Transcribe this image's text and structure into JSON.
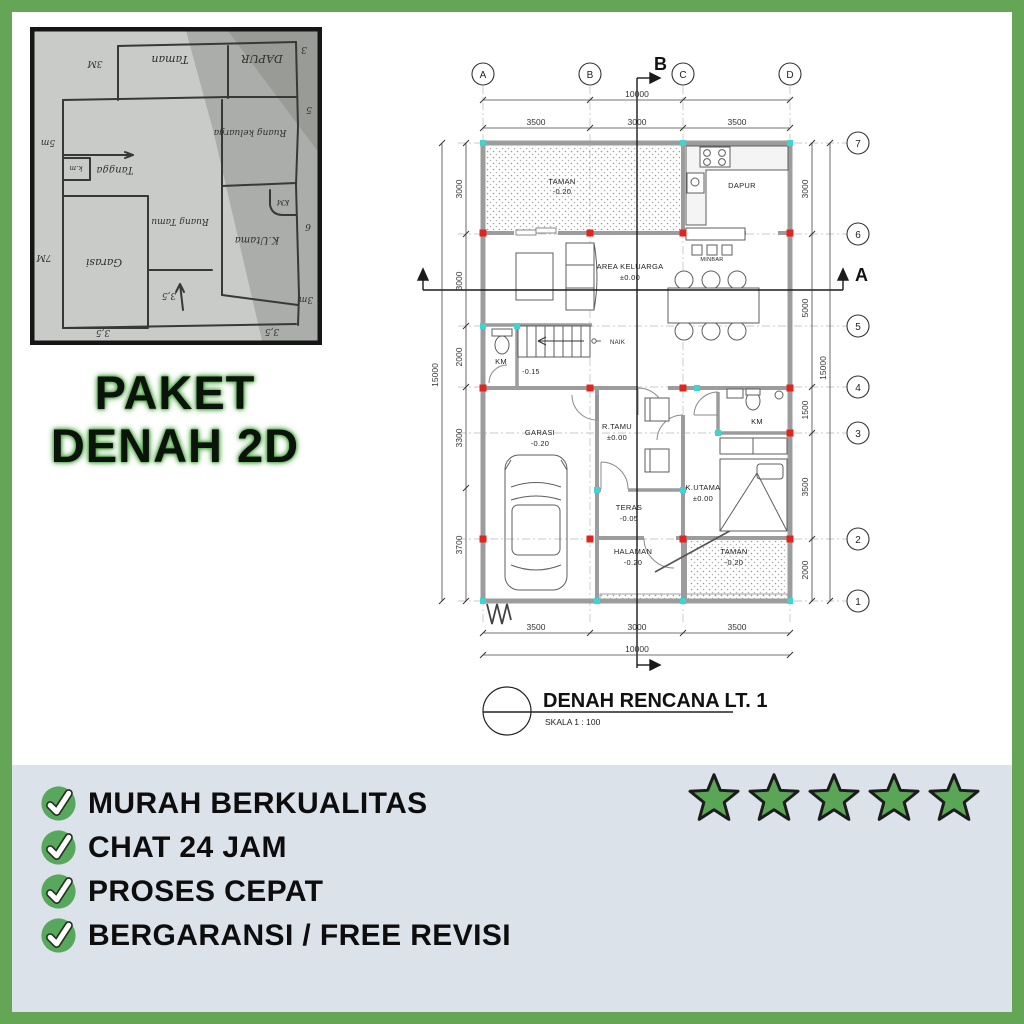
{
  "header": {
    "package_title_line1": "PAKET",
    "package_title_line2": "DENAH 2D"
  },
  "sketch": {
    "labels": {
      "taman": "Taman",
      "dapur": "DAPUR",
      "ruang_keluarga": "Ruang keluarga",
      "tangga": "Tangga",
      "km_tangga": "k.m",
      "garasi": "Garasi",
      "ruang_tamu": "Ruang Tamu",
      "k_utama": "K.Utama",
      "km_kamar": "KM",
      "dim_3m_kiri": "3M",
      "dim_3_kanan": "3",
      "dim_5_kanan": "5",
      "dim_5m_kiri": "5m",
      "dim_6_kanan": "6",
      "dim_7m_kiri": "7M",
      "dim_3m_kanan": "3m",
      "dim_35_tengah": "3,5",
      "dim_35_bawah_kiri": "3,5",
      "dim_35_bawah_kanan": "3,5"
    }
  },
  "plan": {
    "grid_columns": [
      "A",
      "B",
      "C",
      "D"
    ],
    "grid_rows": [
      "7",
      "6",
      "5",
      "4",
      "3",
      "2",
      "1"
    ],
    "section_a": "A",
    "section_b": "B",
    "dim_total_width_top": "10000",
    "dim_total_width_bottom": "10000",
    "dim_total_height_left": "15000",
    "dim_total_height_right": "15000",
    "dims_top": [
      "3500",
      "3000",
      "3500"
    ],
    "dims_bottom": [
      "3500",
      "3000",
      "3500"
    ],
    "dims_left": [
      "3000",
      "3000",
      "2000",
      "3300",
      "3700"
    ],
    "dims_right": [
      "3000",
      "5000",
      "1500",
      "3500",
      "2000"
    ],
    "rooms": [
      {
        "name": "TAMAN",
        "level": "-0.20"
      },
      {
        "name": "DAPUR",
        "level": ""
      },
      {
        "name": "AREA  KELUARGA",
        "level": "±0.00"
      },
      {
        "name": "KM",
        "level": ""
      },
      {
        "name": "GARASI",
        "level": "-0.20"
      },
      {
        "name": "R.TAMU",
        "level": "±0.00"
      },
      {
        "name": "KM",
        "level": ""
      },
      {
        "name": "K.UTAMA",
        "level": "±0.00"
      },
      {
        "name": "TERAS",
        "level": "-0.05"
      },
      {
        "name": "HALAMAN",
        "level": "-0.20"
      },
      {
        "name": "TAMAN",
        "level": "-0.20"
      }
    ],
    "annotations": {
      "minbar": "MINBAR",
      "naik": "NAIK",
      "stair_level": "-0.15"
    },
    "title": "DENAH RENCANA LT. 1",
    "scale": "SKALA  1  :  100"
  },
  "banner": {
    "features": [
      {
        "label": "MURAH BERKUALITAS"
      },
      {
        "label": "CHAT 24 JAM"
      },
      {
        "label": "PROSES CEPAT"
      },
      {
        "label": "BERGARANSI / FREE REVISI"
      }
    ],
    "rating_stars": 5
  },
  "colors": {
    "frame_green": "#64a556",
    "star_green": "#5ba656",
    "check_green": "#57a85c",
    "banner_bg": "#dce2e9",
    "column_red": "#e02420",
    "marker_cyan": "#3fd4cf"
  }
}
